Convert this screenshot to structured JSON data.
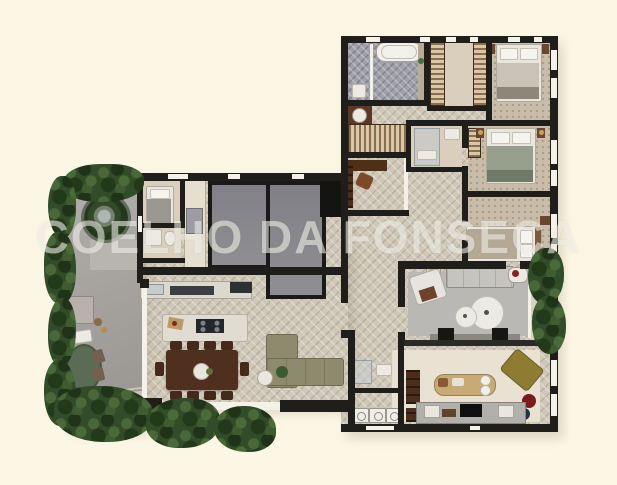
{
  "watermark": {
    "text": "COELHO DA FONSECA"
  },
  "palette": {
    "bg": "#fbf7e4",
    "wall": "#1f1e1b",
    "floor": "#cfc7b8",
    "bathTile": "#9fa0a8",
    "carpet": "#c9bda9",
    "terrace": "#a8a5a1",
    "glass": "#f4f1e8",
    "hedge": "#324b28",
    "hedgeLight": "#49683a",
    "hedgeDark": "#1f3318",
    "darkRoom": "#85858a",
    "diningWood": "#4f2f1d",
    "sofaGray": "#c6c4be",
    "rugGray": "#b9b8b4",
    "rugCream": "#e9e2d3",
    "oliveSofa": "#8d8a6e",
    "mustardChair": "#8d7c31",
    "goldBench": "#c8ab74",
    "greenTable": "#5b6c54",
    "redPouf": "#7c1b1b",
    "bluePouf": "#20304f",
    "watermarkColor": "rgba(246,245,239,0.55)"
  }
}
